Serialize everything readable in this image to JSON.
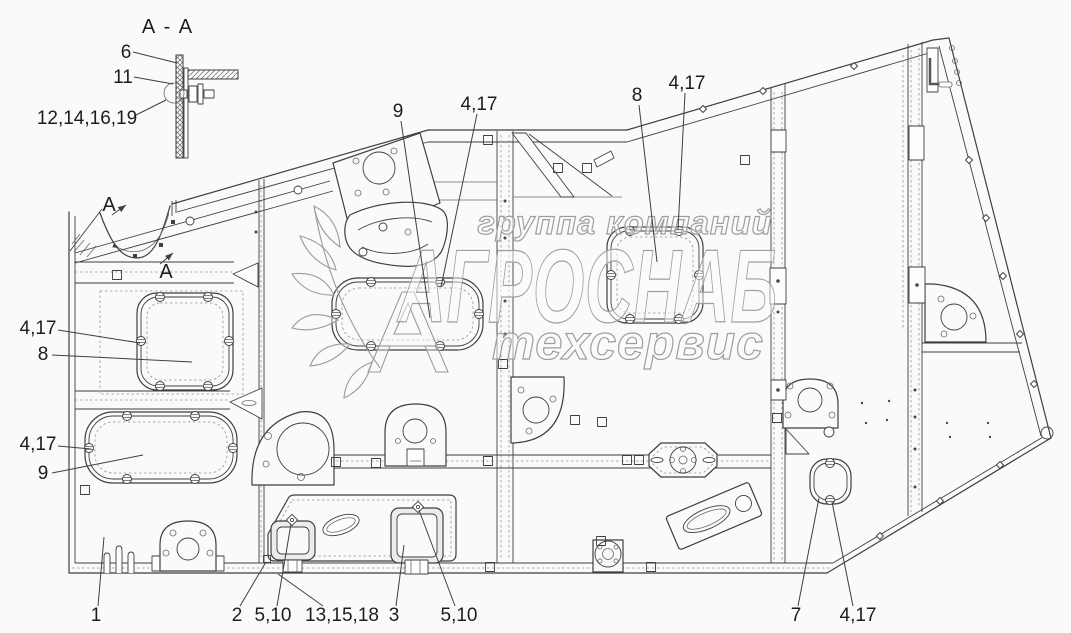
{
  "section_view": {
    "title": "A - A"
  },
  "watermark": {
    "line1": "группа компаний",
    "line2": "АГРОСНАБ",
    "line3": "техсервис"
  },
  "colors": {
    "line": "#3f3f3f",
    "background": "#fafafa",
    "watermark_outline": "#9e9e9e",
    "label_text": "#1d1d1d"
  },
  "section_arrows": [
    {
      "label": "A",
      "tx": 109,
      "ty": 211,
      "ax1": 112,
      "ay1": 215,
      "ax2": 126,
      "ay2": 205
    },
    {
      "label": "A",
      "tx": 166,
      "ty": 278,
      "ax1": 160,
      "ay1": 264,
      "ax2": 173,
      "ay2": 253
    }
  ],
  "callouts": [
    {
      "id": "item-6",
      "label": "6",
      "tx": 126,
      "ty": 58,
      "x1": 133,
      "y1": 52,
      "x2": 177,
      "y2": 63
    },
    {
      "id": "item-11",
      "label": "11",
      "tx": 123,
      "ty": 83,
      "x1": 134,
      "y1": 77,
      "x2": 173,
      "y2": 84
    },
    {
      "id": "items-12-14-16-19",
      "label": "12,14,16,19",
      "tx": 87,
      "ty": 124,
      "x1": 134,
      "y1": 116,
      "x2": 166,
      "y2": 100
    },
    {
      "id": "item-9-top",
      "label": "9",
      "tx": 398,
      "ty": 117,
      "x1": 401,
      "y1": 121,
      "x2": 430,
      "y2": 318
    },
    {
      "id": "items-4-17-top-center",
      "label": "4,17",
      "tx": 479,
      "ty": 110,
      "x1": 477,
      "y1": 114,
      "x2": 441,
      "y2": 287
    },
    {
      "id": "item-8-top",
      "label": "8",
      "tx": 637,
      "ty": 101,
      "x1": 639,
      "y1": 105,
      "x2": 657,
      "y2": 262
    },
    {
      "id": "items-4-17-top-right",
      "label": "4,17",
      "tx": 687,
      "ty": 89,
      "x1": 685,
      "y1": 93,
      "x2": 678,
      "y2": 230
    },
    {
      "id": "items-4-17-left-upper",
      "label": "4,17",
      "tx": 38,
      "ty": 334,
      "x1": 58,
      "y1": 330,
      "x2": 140,
      "y2": 343
    },
    {
      "id": "item-8-left",
      "label": "8",
      "tx": 43,
      "ty": 360,
      "x1": 52,
      "y1": 355,
      "x2": 192,
      "y2": 362
    },
    {
      "id": "items-4-17-left-lower",
      "label": "4,17",
      "tx": 38,
      "ty": 450,
      "x1": 58,
      "y1": 446,
      "x2": 91,
      "y2": 449
    },
    {
      "id": "item-9-left",
      "label": "9",
      "tx": 43,
      "ty": 479,
      "x1": 52,
      "y1": 473,
      "x2": 143,
      "y2": 455
    },
    {
      "id": "item-1",
      "label": "1",
      "tx": 96,
      "ty": 621,
      "x1": 98,
      "y1": 606,
      "x2": 104,
      "y2": 537
    },
    {
      "id": "item-2",
      "label": "2",
      "tx": 237,
      "ty": 621,
      "x1": 240,
      "y1": 606,
      "x2": 266,
      "y2": 562
    },
    {
      "id": "items-5-10-left",
      "label": "5,10",
      "tx": 273,
      "ty": 621,
      "x1": 277,
      "y1": 606,
      "x2": 291,
      "y2": 524
    },
    {
      "id": "items-13-15-18",
      "label": "13,15,18",
      "tx": 342,
      "ty": 621,
      "x1": 323,
      "y1": 606,
      "x2": 278,
      "y2": 574
    },
    {
      "id": "item-3",
      "label": "3",
      "tx": 394,
      "ty": 621,
      "x1": 396,
      "y1": 606,
      "x2": 404,
      "y2": 545
    },
    {
      "id": "items-5-10-right",
      "label": "5,10",
      "tx": 459,
      "ty": 621,
      "x1": 455,
      "y1": 606,
      "x2": 419,
      "y2": 510
    },
    {
      "id": "item-7",
      "label": "7",
      "tx": 796,
      "ty": 621,
      "x1": 798,
      "y1": 606,
      "x2": 819,
      "y2": 498
    },
    {
      "id": "items-4-17-bottom-right",
      "label": "4,17",
      "tx": 858,
      "ty": 621,
      "x1": 853,
      "y1": 606,
      "x2": 832,
      "y2": 502
    }
  ]
}
